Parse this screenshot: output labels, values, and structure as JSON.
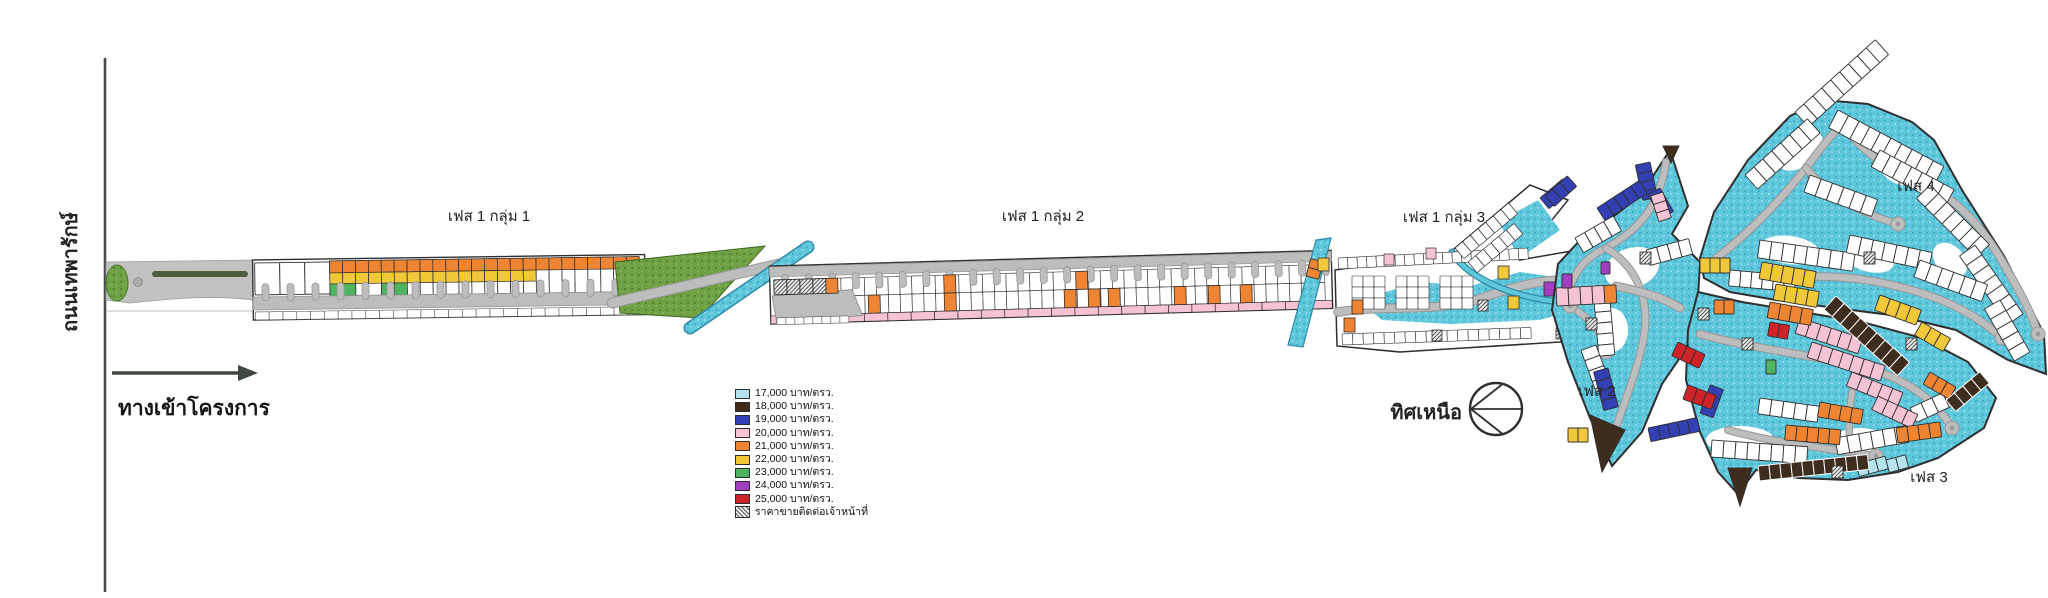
{
  "road": {
    "name": "ถนนเทพารักษ์"
  },
  "entrance": {
    "label": "ทางเข้าโครงการ"
  },
  "phases": {
    "p1g1": "เฟส 1 กลุ่ม 1",
    "p1g2": "เฟส 1 กลุ่ม 2",
    "p1g3": "เฟส 1 กลุ่ม 3",
    "p2": "เฟส 2",
    "p3": "เฟส 3",
    "p4": "เฟส 4"
  },
  "compass": {
    "label": "ทิศเหนือ"
  },
  "legend": {
    "items": [
      {
        "label": "17,000 บาท/ตรว.",
        "color": "#b5e4ef"
      },
      {
        "label": "18,000 บาท/ตรว.",
        "color": "#3e2d1d"
      },
      {
        "label": "19,000 บาท/ตรว.",
        "color": "#3340b4"
      },
      {
        "label": "20,000 บาท/ตรว.",
        "color": "#f6c3d5"
      },
      {
        "label": "21,000 บาท/ตรว.",
        "color": "#ef8532"
      },
      {
        "label": "22,000 บาท/ตรว.",
        "color": "#f2c83b"
      },
      {
        "label": "23,000 บาท/ตรว.",
        "color": "#4fb45f"
      },
      {
        "label": "24,000 บาท/ตรว.",
        "color": "#a43ec1"
      },
      {
        "label": "25,000 บาท/ตรว.",
        "color": "#cd2329"
      }
    ],
    "contact_label": "ราคาขายติดต่อเจ้าหน้าที่"
  },
  "map_colors": {
    "outline": "#2f2f2f",
    "road_fill": "#bdbdbd",
    "road_edge": "#979797",
    "water": "#5ec7dc",
    "water_dot_dark": "#2f9fbe",
    "water_dot_light": "#a9e4ef",
    "grass": "#6fa043",
    "grass_dot": "#4d7d2a",
    "canal_edge": "#2f8aa8",
    "main_road_line": "#4a4a4a",
    "arrow": "#3e4a40",
    "median_green": "#4e5e3e",
    "plot_fill": "#ffffff",
    "strip_pink": "#f6c3d5"
  }
}
